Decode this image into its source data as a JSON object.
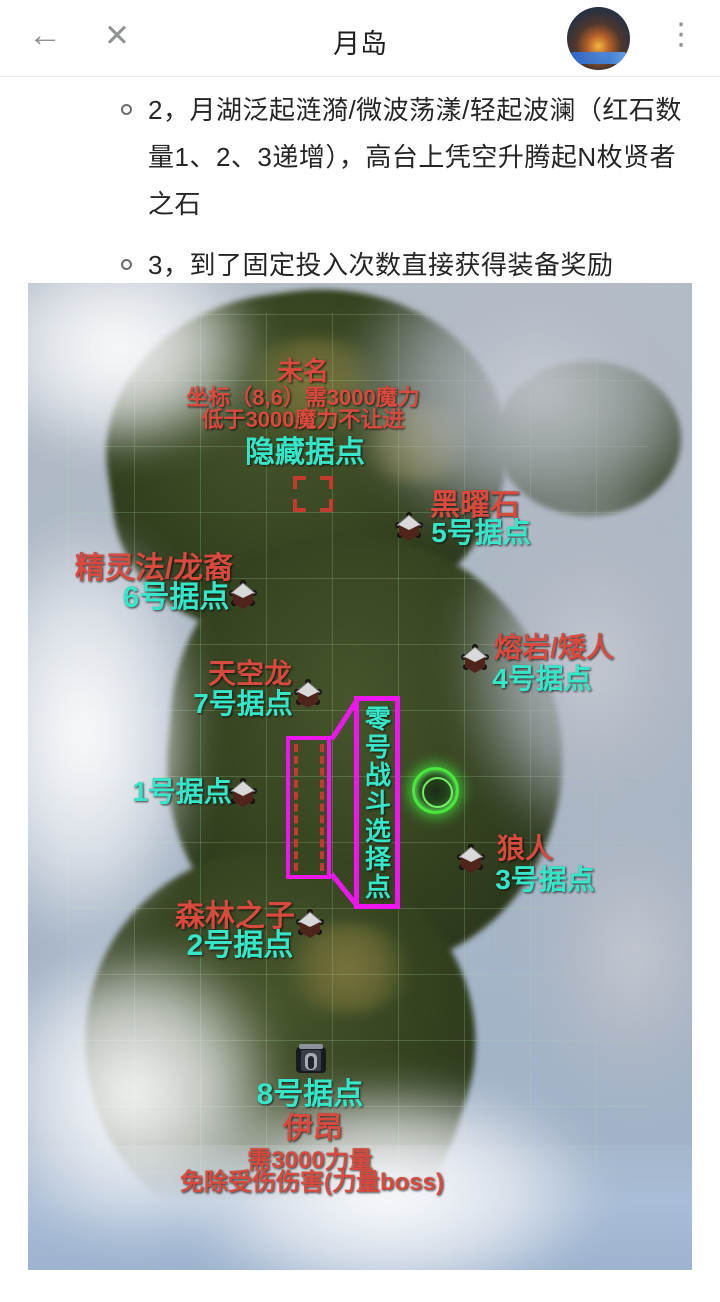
{
  "header": {
    "title": "月岛",
    "icons": {
      "back": "←",
      "close": "✕",
      "menu": "⋮"
    }
  },
  "content": {
    "bullets": [
      "2，月湖泛起涟漪/微波荡漾/轻起波澜（红石数量1、2、3递增），高台上凭空升腾起N枚贤者之石",
      "3，到了固定投入次数直接获得装备奖励"
    ]
  },
  "map": {
    "hidden": {
      "boss": "未名",
      "req1": "坐标（8,6）需3000魔力",
      "req2": "低于3000魔力不让进",
      "label": "隐藏据点"
    },
    "base5": {
      "boss": "黑曜石",
      "label": "5号据点"
    },
    "base6": {
      "boss": "精灵法/龙裔",
      "label": "6号据点"
    },
    "base4": {
      "boss": "熔岩/矮人",
      "label": "4号据点"
    },
    "base7": {
      "boss": "天空龙",
      "label": "7号据点"
    },
    "base1": {
      "label": "1号据点"
    },
    "zero": {
      "label": "零号战斗选择点"
    },
    "base3": {
      "boss": "狼人",
      "label": "3号据点"
    },
    "base2": {
      "boss": "森林之子",
      "label": "2号据点"
    },
    "base8": {
      "label": "8号据点",
      "boss": "伊昂",
      "req1": "需3000力量",
      "req2": "免除受伤伤害(力量boss)"
    }
  },
  "colors": {
    "boss_red": "#d84a3e",
    "base_cyan": "#35e6c8",
    "callout_magenta": "#ee16ee",
    "marker_red": "#c53a2e"
  }
}
